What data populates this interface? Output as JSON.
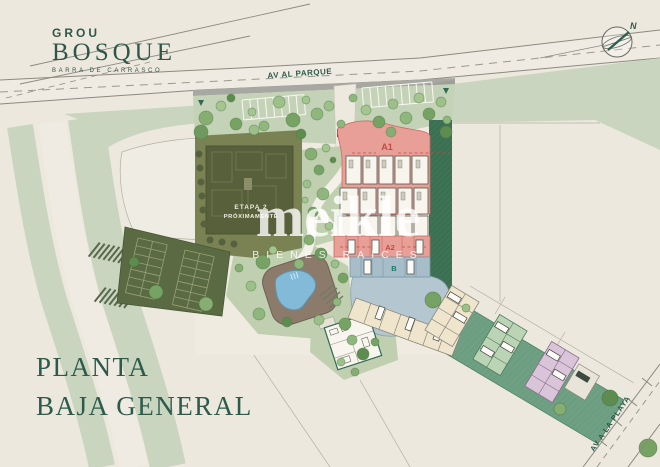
{
  "logo": {
    "brand": "GROU",
    "name": "BOSQUE",
    "tagline": "BARRA DE CARRASCO"
  },
  "title": {
    "line1": "PLANTA",
    "line2": "BAJA GENERAL"
  },
  "watermark": {
    "brand": "meikle",
    "tagline": "BIENES RAÍCES"
  },
  "streets": {
    "top": "AV AL PARQUE",
    "side": "AV A LA PLAYA"
  },
  "compass": {
    "north": "N"
  },
  "labels": {
    "a1": "A1",
    "a2": "A2",
    "b": "B",
    "stage1": "ETAPA 2",
    "stage2": "PRÓXIMAMENTE"
  },
  "colors": {
    "paper": "#ECE8DE",
    "road_line": "#8C8A80",
    "verge_green": "#C9D5BE",
    "lawn": "#BFCFAF",
    "hedge": "#3E7355",
    "olive_ground": "#7A8253",
    "olive_building": "#575F3B",
    "parking": "#5A6A42",
    "pink_building": "#E79F98",
    "blue_building": "#A7BECA",
    "water": "#B4C6CF",
    "pool": "#83BAD8",
    "deck": "#8C7B6B",
    "strip_green": "#6FA083",
    "unit_cream": "#EFE5CD",
    "unit_green": "#BCD4B6",
    "unit_pink": "#D9C4D9",
    "brand_green": "#30564A",
    "label_red": "#C14B41",
    "label_teal": "#177A62"
  }
}
